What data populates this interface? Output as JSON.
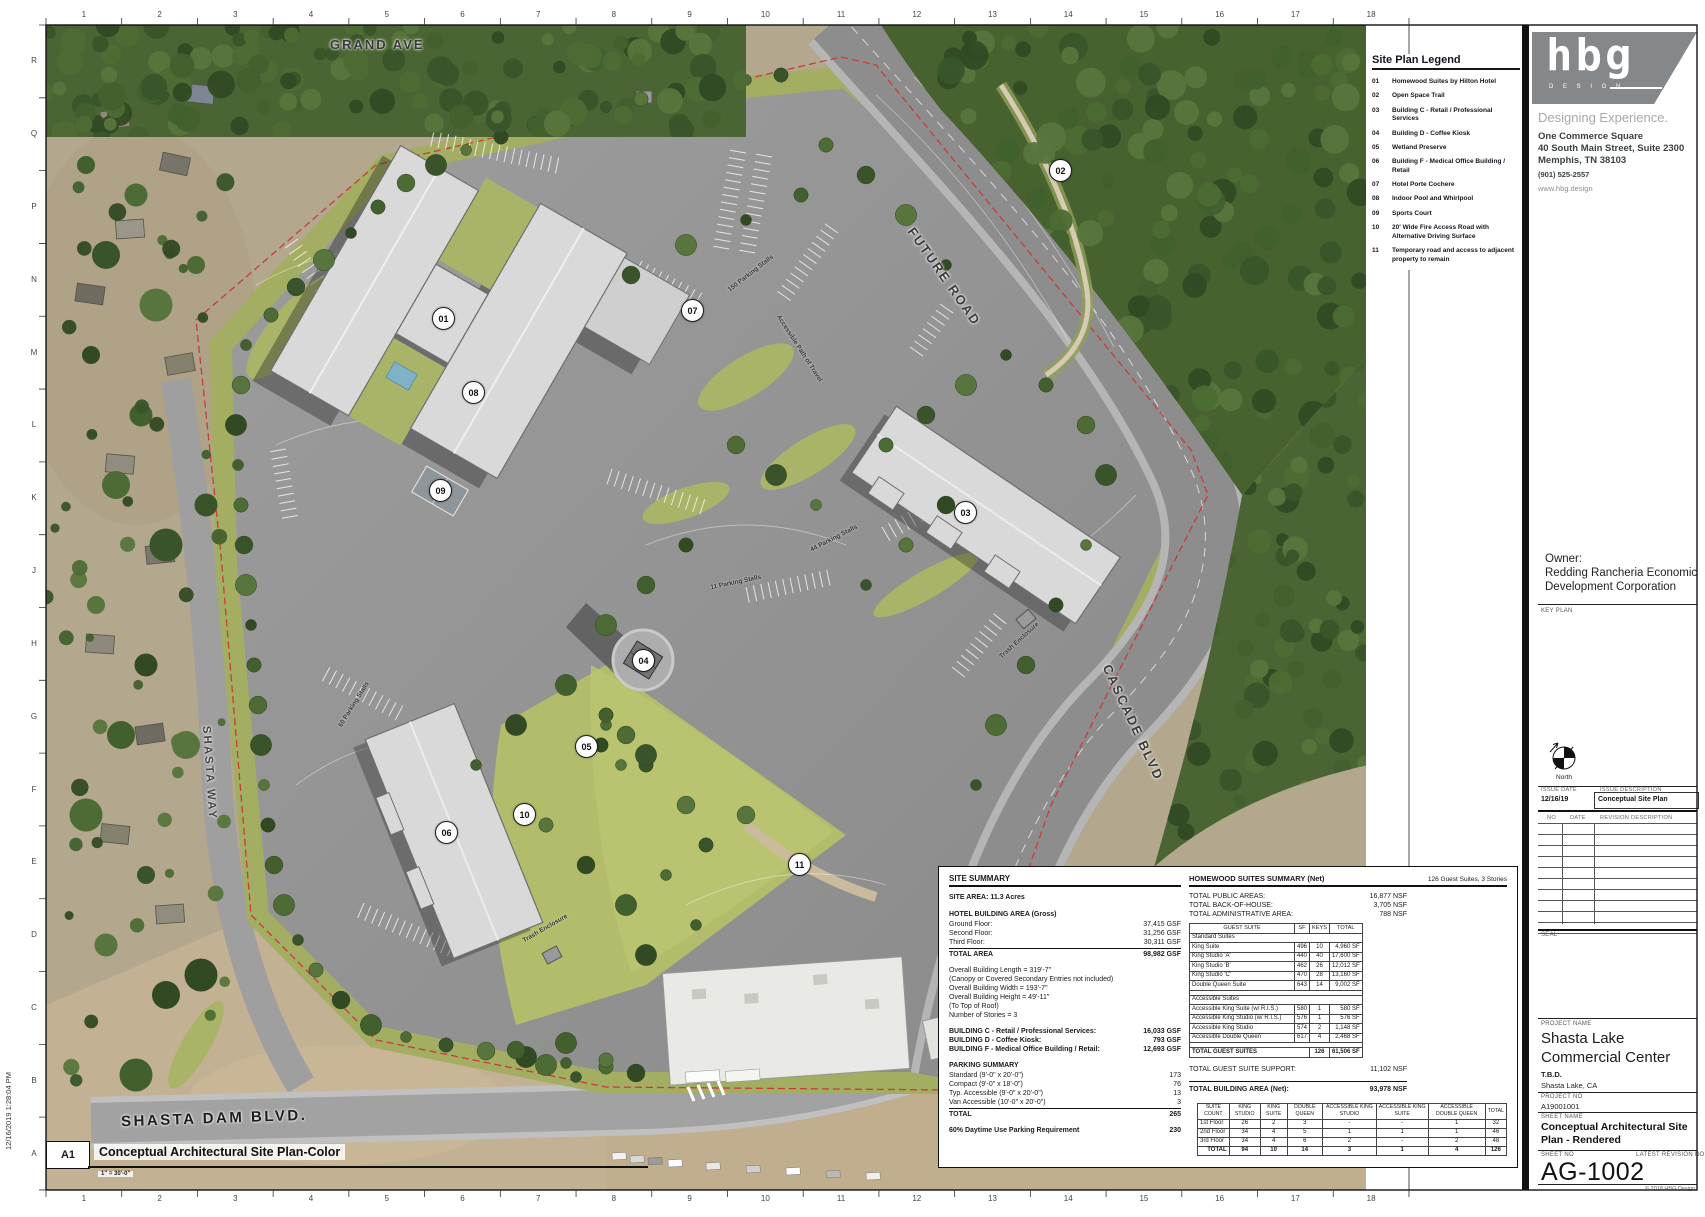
{
  "sheet": {
    "timestamp": "12/16/2019 1:28:04 PM",
    "grid_cols": [
      "1",
      "2",
      "3",
      "4",
      "5",
      "6",
      "7",
      "8",
      "9",
      "10",
      "11",
      "12",
      "13",
      "14",
      "15",
      "16",
      "17",
      "18"
    ],
    "grid_rows": [
      "R",
      "Q",
      "P",
      "N",
      "M",
      "L",
      "K",
      "J",
      "H",
      "G",
      "F",
      "E",
      "D",
      "C",
      "B",
      "A"
    ]
  },
  "legend": {
    "title": "Site Plan Legend",
    "items": [
      {
        "no": "01",
        "label": "Homewood Suites by Hilton Hotel"
      },
      {
        "no": "02",
        "label": "Open Space Trail"
      },
      {
        "no": "03",
        "label": "Building C - Retail / Professional Services"
      },
      {
        "no": "04",
        "label": "Building D - Coffee Kiosk"
      },
      {
        "no": "05",
        "label": "Wetland Preserve"
      },
      {
        "no": "06",
        "label": "Building F - Medical Office Building / Retail"
      },
      {
        "no": "07",
        "label": "Hotel Porte Cochere"
      },
      {
        "no": "08",
        "label": "Indoor Pool and Whirlpool"
      },
      {
        "no": "09",
        "label": "Sports Court"
      },
      {
        "no": "10",
        "label": "20' Wide Fire Access Road with Alternative Driving Surface"
      },
      {
        "no": "11",
        "label": "Temporary road and access to adjacent property to remain"
      }
    ]
  },
  "firm": {
    "logo": "hbg",
    "logo_sub": "D E S I G N",
    "tagline": "Designing Experience.",
    "address1": "One Commerce Square",
    "address2": "40 South Main Street, Suite 2300",
    "address3": "Memphis, TN 38103",
    "phone": "(901) 525-2557",
    "website": "www.hbg.design"
  },
  "owner": {
    "label": "Owner:",
    "line1": "Redding Rancheria Economic",
    "line2": "Development Corporation"
  },
  "panel": {
    "key_plan_label": "KEY PLAN",
    "compass_label": "North",
    "seal_label": "SEAL"
  },
  "issue": {
    "date_header": "ISSUE DATE",
    "desc_header": "ISSUE DESCRIPTION",
    "rows": [
      {
        "date": "12/16/19",
        "desc": "Conceptual Site Plan"
      }
    ]
  },
  "revisions": {
    "no_header": "NO",
    "date_header": "DATE",
    "desc_header": "REVISION DESCRIPTION"
  },
  "project": {
    "name_label": "PROJECT NAME",
    "name": "Shasta Lake Commercial Center",
    "tbd": "T.B.D.",
    "location": "Shasta Lake, CA",
    "no_label": "PROJECT NO",
    "no": "A19001001",
    "sheet_name_label": "SHEET NAME",
    "sheet_name": "Conceptual Architectural Site Plan - Rendered",
    "sheet_no_label": "SHEET NO",
    "latest_rev_label": "LATEST REVISION NO",
    "sheet_no": "AG-1002",
    "copyright": "© 2018 HBG Design"
  },
  "site_summary": {
    "title": "SITE SUMMARY",
    "site_area": "SITE AREA: 11.3 Acres",
    "hotel_header": "HOTEL BUILDING AREA (Gross)",
    "floors": [
      {
        "label": "Ground Floor:",
        "value": "37,415 GSF"
      },
      {
        "label": "Second Floor:",
        "value": "31,256 GSF"
      },
      {
        "label": "Third Floor:",
        "value": "30,311 GSF"
      }
    ],
    "total": {
      "label": "TOTAL AREA",
      "value": "98,982 GSF"
    },
    "dims": [
      "Overall Building Length = 319'-7\"",
      "(Canopy or Covered Secondary Entries not included)",
      "Overall Building Width = 193'-7\"",
      "Overall Building Height = 49'-11\"",
      "(To Top of Roof)",
      "Number of Stories = 3"
    ],
    "buildings": [
      {
        "label": "BUILDING C - Retail / Professional Services:",
        "value": "16,033 GSF"
      },
      {
        "label": "BUILDING D - Coffee Kiosk:",
        "value": "793 GSF"
      },
      {
        "label": "BUILDING F - Medical Office Building / Retail:",
        "value": "12,693 GSF"
      }
    ],
    "parking_header": "PARKING SUMMARY",
    "parking": [
      {
        "label": "Standard (9'-0\" x 20'-0\")",
        "value": "173"
      },
      {
        "label": "Compact (9'-0\" x 18'-0\")",
        "value": "76"
      },
      {
        "label": "Typ. Accessible (9'-0\" x 20'-0\")",
        "value": "13"
      },
      {
        "label": "Van Accessible (10'-0\" x 20'-0\")",
        "value": "3"
      }
    ],
    "parking_total": {
      "label": "TOTAL",
      "value": "265"
    },
    "daytime": {
      "label": "60% Daytime Use Parking Requirement",
      "value": "230"
    }
  },
  "homewood": {
    "title": "HOMEWOOD SUITES SUMMARY (Net)",
    "subtitle": "126 Guest Suites, 3 Stories",
    "totals": [
      {
        "label": "TOTAL PUBLIC AREAS:",
        "value": "16,877 NSF"
      },
      {
        "label": "TOTAL BACK-OF-HOUSE:",
        "value": "3,705 NSF"
      },
      {
        "label": "TOTAL ADMINISTRATIVE AREA:",
        "value": "788 NSF"
      }
    ],
    "table": {
      "headers": [
        "GUEST SUITE",
        "SF",
        "KEYS",
        "TOTAL"
      ],
      "sections": [
        {
          "name": "Standard Suites",
          "rows": [
            [
              "King Suite",
              "496",
              "10",
              "4,960 SF"
            ],
            [
              "King Studio 'A'",
              "440",
              "40",
              "17,600 SF"
            ],
            [
              "King Studio 'B'",
              "462",
              "26",
              "12,012 SF"
            ],
            [
              "King Studio 'C'",
              "470",
              "28",
              "13,160 SF"
            ],
            [
              "Double Queen Suite",
              "643",
              "14",
              "9,002 SF"
            ]
          ]
        },
        {
          "name": "Accessible Suites",
          "rows": [
            [
              "Accessible King Suite (w/ R.I.S.)",
              "580",
              "1",
              "580 SF"
            ],
            [
              "Accessible King Studio (w/ R.I.S.)",
              "576",
              "1",
              "576 SF"
            ],
            [
              "Accessible King Studio",
              "574",
              "2",
              "1,148 SF"
            ],
            [
              "Accessible Double Queen",
              "617",
              "4",
              "2,468 SF"
            ]
          ]
        }
      ],
      "total_row": [
        "TOTAL GUEST SUITES",
        "",
        "126",
        "61,506 SF"
      ]
    },
    "support": {
      "label": "TOTAL GUEST SUITE SUPPORT:",
      "value": "11,102 NSF"
    },
    "building_total": {
      "label": "TOTAL BUILDING AREA (Net):",
      "value": "93,978 NSF"
    }
  },
  "suite_count": {
    "headers": [
      "SUITE COUNT",
      "KING STUDIO",
      "KING SUITE",
      "DOUBLE QUEEN",
      "ACCESSIBLE KING STUDIO",
      "ACCESSIBLE KING SUITE",
      "ACCESSIBLE DOUBLE QUEEN",
      "TOTAL"
    ],
    "rows": [
      [
        "1st Floor",
        "26",
        "2",
        "3",
        "-",
        "-",
        "1",
        "32"
      ],
      [
        "2nd Floor",
        "34",
        "4",
        "5",
        "1",
        "1",
        "1",
        "46"
      ],
      [
        "3rd Floor",
        "34",
        "4",
        "6",
        "2",
        "-",
        "2",
        "48"
      ]
    ],
    "total": [
      "TOTAL",
      "94",
      "10",
      "14",
      "3",
      "1",
      "4",
      "126"
    ]
  },
  "plan": {
    "markers": [
      {
        "no": "01",
        "x": 397,
        "y": 293
      },
      {
        "no": "02",
        "x": 1014,
        "y": 145
      },
      {
        "no": "03",
        "x": 919,
        "y": 487
      },
      {
        "no": "04",
        "x": 597,
        "y": 635
      },
      {
        "no": "05",
        "x": 540,
        "y": 721
      },
      {
        "no": "06",
        "x": 400,
        "y": 807
      },
      {
        "no": "07",
        "x": 646,
        "y": 285
      },
      {
        "no": "08",
        "x": 427,
        "y": 367
      },
      {
        "no": "09",
        "x": 394,
        "y": 465
      },
      {
        "no": "10",
        "x": 478,
        "y": 789
      },
      {
        "no": "11",
        "x": 753,
        "y": 839
      }
    ],
    "streets": [
      {
        "text": "GRAND AVE",
        "x": 284,
        "y": 12,
        "rot": 0,
        "cls": "lg"
      },
      {
        "text": "FUTURE ROAD",
        "x": 840,
        "y": 244,
        "rot": 55,
        "cls": "lg"
      },
      {
        "text": "CASCADE BLVD",
        "x": 1024,
        "y": 690,
        "rot": 65,
        "cls": "lg"
      },
      {
        "text": "SHASTA WAY",
        "x": 116,
        "y": 742,
        "rot": 86,
        "cls": "md"
      },
      {
        "text": "SHASTA DAM BLVD.",
        "x": 75,
        "y": 1085,
        "rot": -2,
        "cls": "xl"
      }
    ],
    "notes": [
      {
        "text": "150 Parking Stalls",
        "x": 677,
        "y": 245,
        "rot": -38
      },
      {
        "text": "Accessible Path of Travel",
        "x": 714,
        "y": 320,
        "rot": 57
      },
      {
        "text": "44 Parking Stalls",
        "x": 762,
        "y": 510,
        "rot": -27
      },
      {
        "text": "11 Parking Stalls",
        "x": 664,
        "y": 554,
        "rot": -12
      },
      {
        "text": "60 Parking Stalls",
        "x": 282,
        "y": 676,
        "rot": -58
      },
      {
        "text": "Trash Enclosure",
        "x": 948,
        "y": 612,
        "rot": -42
      },
      {
        "text": "Trash Enclosure",
        "x": 474,
        "y": 900,
        "rot": -30
      }
    ]
  },
  "title_strip": {
    "ref": "A1",
    "title": "Conceptual Architectural Site Plan-Color",
    "scale": "1\" = 30'-0\""
  }
}
